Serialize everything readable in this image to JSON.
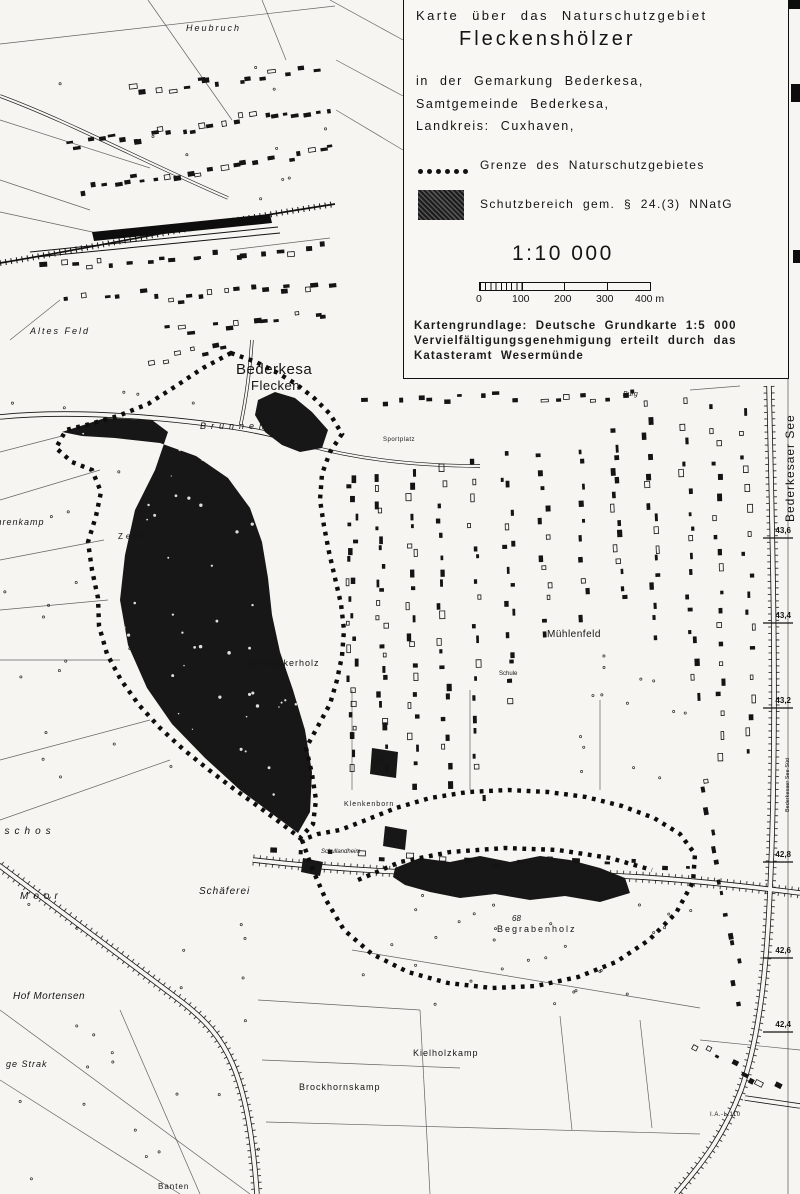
{
  "legend": {
    "title_line": "Karte über das Naturschutzgebiet",
    "name": "Fleckenshölzer",
    "subtitle_lines": [
      "in der Gemarkung Bederkesa,",
      "Samtgemeinde Bederkesa,",
      "Landkreis: Cuxhaven,"
    ],
    "entries": [
      {
        "symbol": "dotted-line",
        "label": "Grenze des Naturschutzgebietes"
      },
      {
        "symbol": "filled-area",
        "label": "Schutzbereich gem. § 24.(3) NNatG"
      }
    ],
    "scale": {
      "ratio": "1:10 000",
      "ticks": [
        "0",
        "100",
        "200",
        "300",
        "400 m"
      ]
    },
    "attribution_lines": [
      "Kartengrundlage: Deutsche Grundkarte 1:5 000",
      "Vervielfältigungsgenehmigung erteilt durch das",
      "Katasteramt Wesermünde"
    ]
  },
  "map": {
    "colors": {
      "ink": "#141414",
      "paper": "#f6f5f1"
    },
    "labels": [
      {
        "text": "Heubruch",
        "x": 186,
        "y": 31,
        "size": 9,
        "italic": true,
        "spacing": 2
      },
      {
        "text": "Bederkesa",
        "x": 236,
        "y": 374,
        "size": 15,
        "spacing": 0.5
      },
      {
        "text": "Flecken",
        "x": 251,
        "y": 390,
        "size": 13,
        "spacing": 0.5
      },
      {
        "text": "Brunnen",
        "x": 200,
        "y": 429,
        "size": 9,
        "italic": true,
        "spacing": 5
      },
      {
        "text": "Sportplatz",
        "x": 383,
        "y": 441,
        "size": 6,
        "spacing": 0.5
      },
      {
        "text": "Altes Feld",
        "x": 30,
        "y": 334,
        "size": 9,
        "italic": true,
        "spacing": 2
      },
      {
        "text": "Ihrenkamp",
        "x": -7,
        "y": 525,
        "size": 9,
        "italic": true,
        "spacing": 1
      },
      {
        "text": "Zech",
        "x": 118,
        "y": 539,
        "size": 8,
        "spacing": 3
      },
      {
        "text": "Spitzeckerholz",
        "x": 247,
        "y": 666,
        "size": 9,
        "spacing": 1
      },
      {
        "text": "Mühlenfeld",
        "x": 547,
        "y": 637,
        "size": 10,
        "spacing": 0.5
      },
      {
        "text": "Schule",
        "x": 499,
        "y": 675,
        "size": 6
      },
      {
        "text": "Klenkenborn",
        "x": 344,
        "y": 806,
        "size": 7,
        "spacing": 1
      },
      {
        "text": "Schullandheim",
        "x": 321,
        "y": 853,
        "size": 6,
        "italic": true
      },
      {
        "text": "Schäferei",
        "x": 199,
        "y": 894,
        "size": 10,
        "italic": true,
        "spacing": 1
      },
      {
        "text": "Moor",
        "x": 20,
        "y": 899,
        "size": 10,
        "italic": true,
        "spacing": 5
      },
      {
        "text": "nschos",
        "x": -6,
        "y": 834,
        "size": 10,
        "italic": true,
        "spacing": 5
      },
      {
        "text": "Hof Mortensen",
        "x": 13,
        "y": 999,
        "size": 10,
        "italic": true,
        "spacing": 0.5
      },
      {
        "text": "ge Strak",
        "x": 6,
        "y": 1067,
        "size": 9,
        "italic": true,
        "spacing": 1
      },
      {
        "text": "68",
        "x": 512,
        "y": 921,
        "size": 8,
        "italic": true
      },
      {
        "text": "Begrabenholz",
        "x": 497,
        "y": 932,
        "size": 9,
        "spacing": 2
      },
      {
        "text": "Brockhornskamp",
        "x": 299,
        "y": 1090,
        "size": 9,
        "spacing": 1
      },
      {
        "text": "Kielholzkamp",
        "x": 413,
        "y": 1056,
        "size": 9,
        "spacing": 1
      },
      {
        "text": "Banten",
        "x": 158,
        "y": 1189,
        "size": 8,
        "spacing": 1
      },
      {
        "text": "Burg",
        "x": 623,
        "y": 396,
        "size": 7,
        "italic": true
      },
      {
        "text": "I.A.-L.110",
        "x": 710,
        "y": 1116,
        "size": 6,
        "spacing": 0.5
      },
      {
        "text": "Bederkesaer See",
        "x": 794,
        "y": 522,
        "size": 12,
        "spacing": 1,
        "rotate": -90
      },
      {
        "text": "Bederkesaer See-Süd",
        "x": 789,
        "y": 812,
        "size": 5.5,
        "rotate": -90
      }
    ],
    "elevations": [
      {
        "text": "43,6",
        "y": 533
      },
      {
        "text": "43,4",
        "y": 618
      },
      {
        "text": "43,2",
        "y": 703
      },
      {
        "text": "42,8",
        "y": 857
      },
      {
        "text": "42,6",
        "y": 953
      },
      {
        "text": "42,4",
        "y": 1027
      }
    ]
  }
}
